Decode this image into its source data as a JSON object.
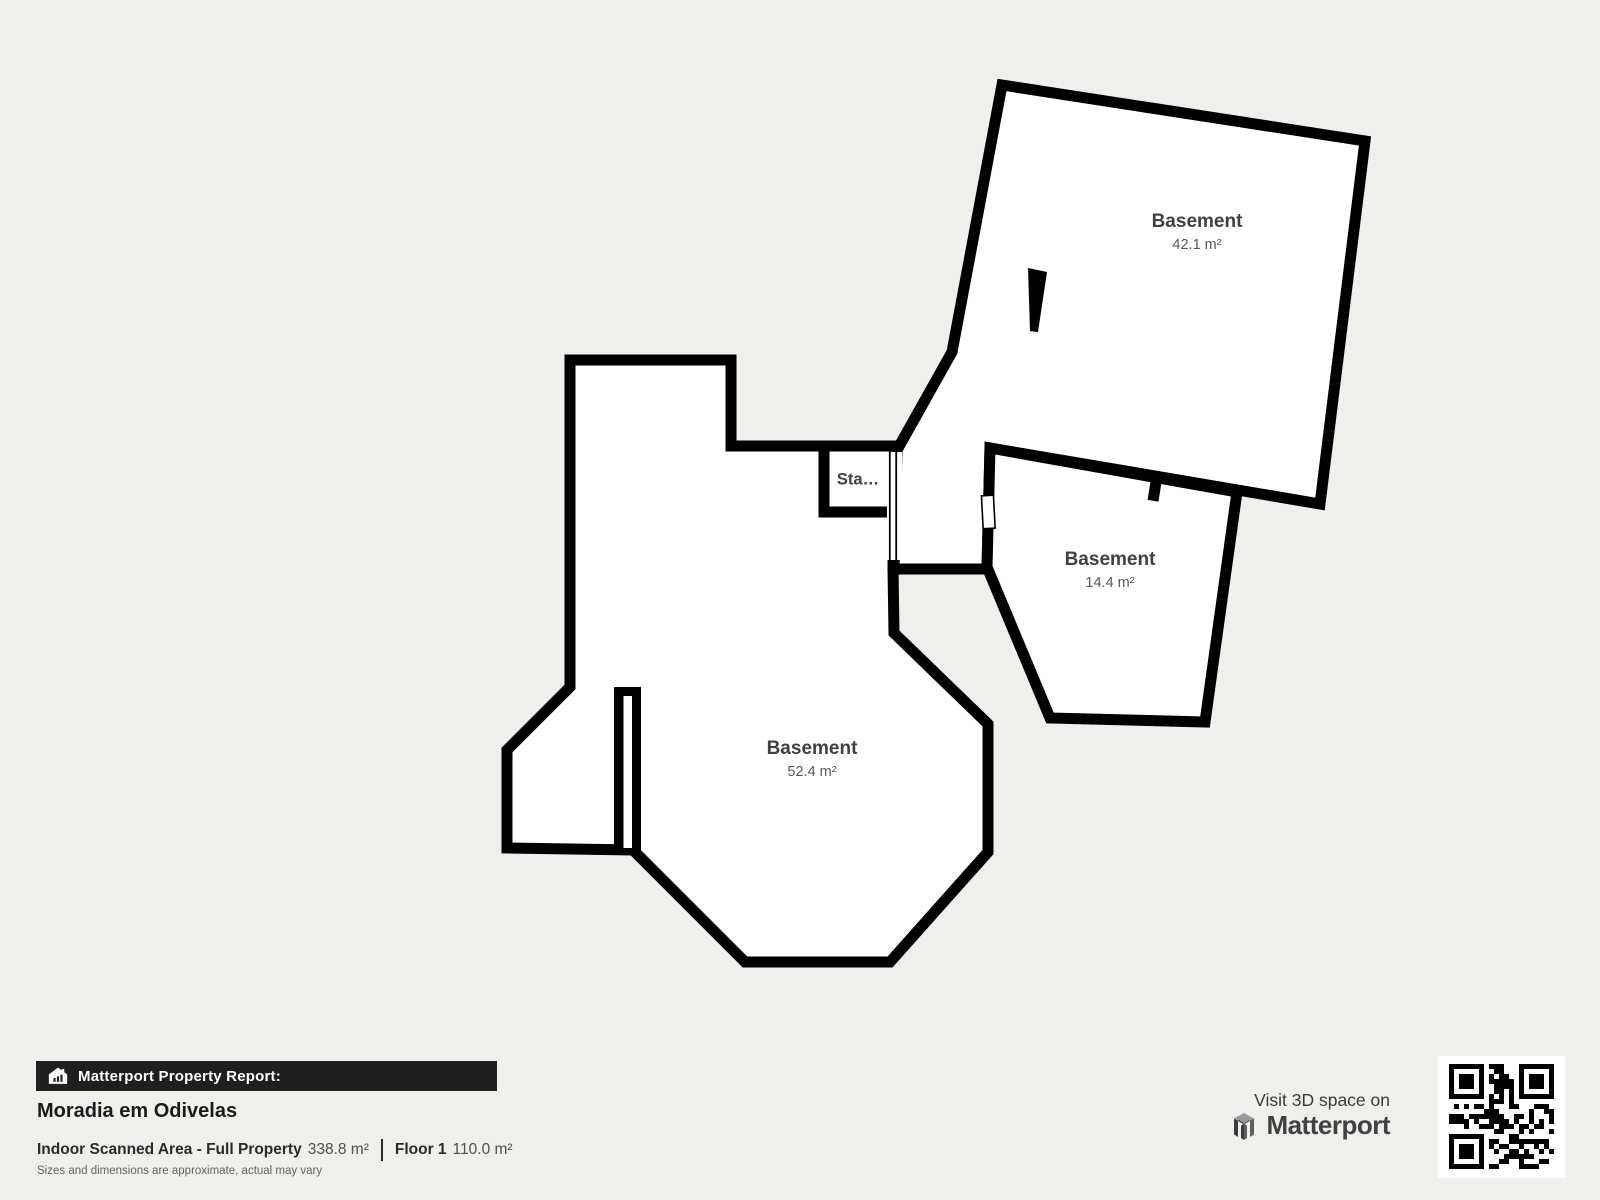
{
  "plan": {
    "rooms": [
      {
        "id": "basement-large",
        "name": "Basement",
        "area": "42.1 m²"
      },
      {
        "id": "basement-small",
        "name": "Basement",
        "area": "14.4 m²"
      },
      {
        "id": "basement-main",
        "name": "Basement",
        "area": "52.4 m²"
      }
    ],
    "stairs_label": "Sta…"
  },
  "footer": {
    "report_badge": "Matterport Property Report:",
    "property_title": "Moradia em Odivelas",
    "scanned_area_label": "Indoor Scanned Area - Full Property",
    "scanned_area_value": "338.8 m²",
    "floor_label": "Floor 1",
    "floor_value": "110.0 m²",
    "disclaimer": "Sizes and dimensions are approximate, actual may vary"
  },
  "cta": {
    "visit_text": "Visit 3D space on",
    "brand": "Matterport"
  },
  "colors": {
    "background": "#f0efec",
    "wall": "#000000",
    "room_fill": "#ffffff",
    "bar_background": "#1f1f1f",
    "label_text": "#3e4042"
  }
}
